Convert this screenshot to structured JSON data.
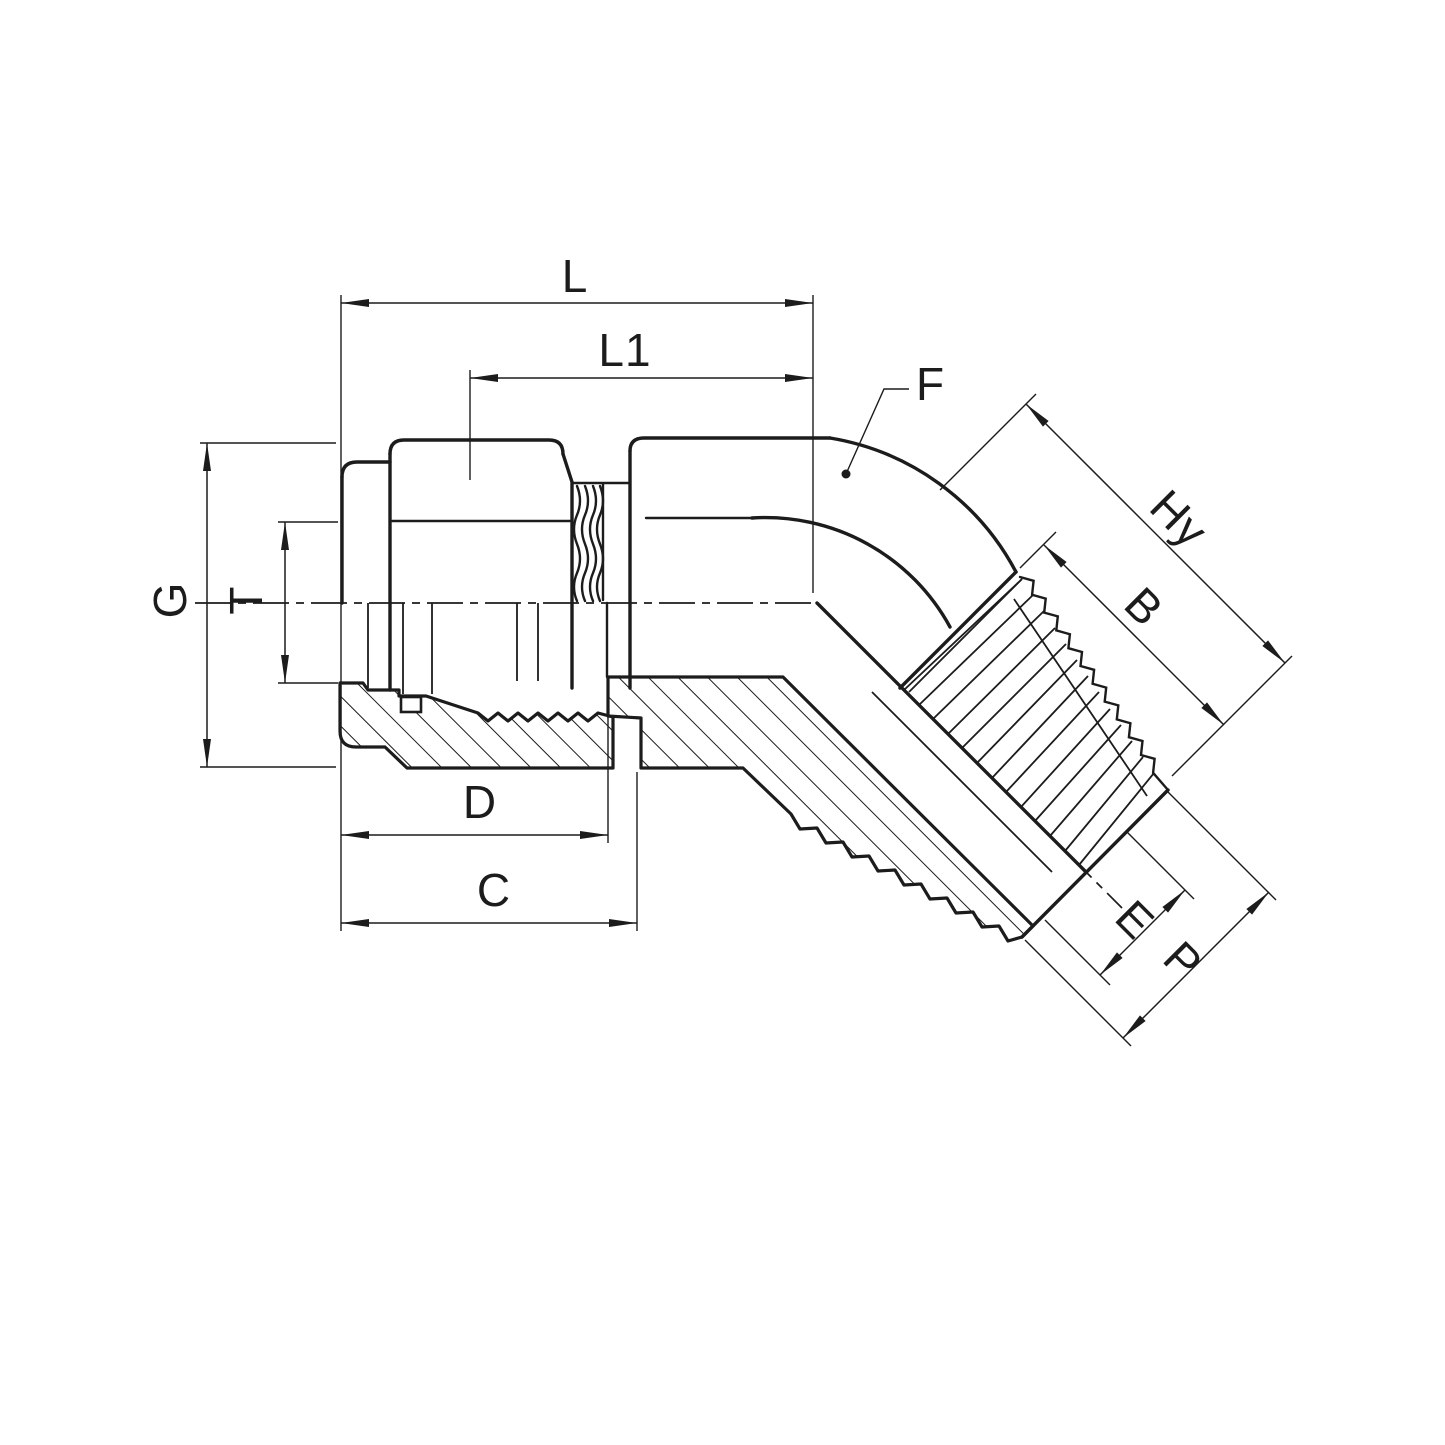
{
  "page": {
    "background_color": "#ffffff",
    "line_color": "#1c1c1c"
  },
  "drawing": {
    "type": "technical-dimension-drawing",
    "subject": "45-degree male elbow compression tube fitting shown in half-section with dimension callouts",
    "view": "side elevation, lower half sectioned with hatching",
    "dimensions": {
      "L": {
        "label": "L"
      },
      "L1": {
        "label": "L1"
      },
      "F": {
        "label": "F"
      },
      "Hy": {
        "label": "Hy"
      },
      "B": {
        "label": "B"
      },
      "G": {
        "label": "G"
      },
      "T": {
        "label": "T"
      },
      "D": {
        "label": "D"
      },
      "C": {
        "label": "C"
      },
      "E": {
        "label": "E"
      },
      "P": {
        "label": "P"
      }
    }
  }
}
